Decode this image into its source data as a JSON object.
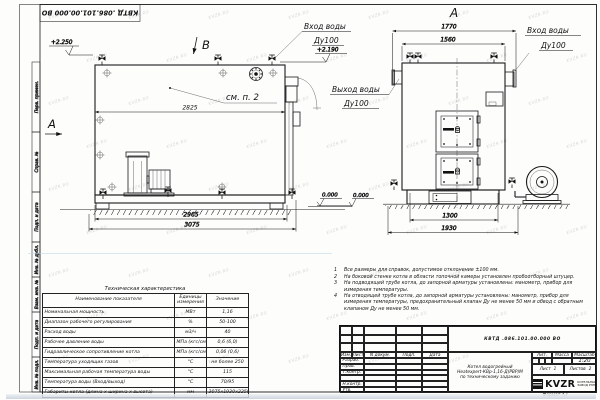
{
  "sheet": {
    "doc_number": "КВТД .086.101.00.000  ВО",
    "format_label": "Формат  А3",
    "title_line1": "Котел водогрейный",
    "title_line2": "Heatexpert-КВр-1,16-Д(РВР)М",
    "title_line3": "по техническому заданию",
    "scale_value": "1:20",
    "lit_label": "Лит.",
    "mass_label": "Масса",
    "scale_label": "Масштаб",
    "sheet_label": "Лист",
    "sheet_value": "1",
    "sheets_label": "Листов",
    "sheets_value": "2",
    "logo_text": "KVZR",
    "logo_sub1": "КОТЕЛЬНЫЙ",
    "logo_sub2": "ЗАВОД РЭП",
    "header_cols": [
      "Изм.",
      "Лист",
      "N докум.",
      "Подп.",
      "Дата"
    ],
    "sig_rows": [
      "Разраб.",
      "Пров.",
      "Т.контр.",
      "",
      "Н.контр.",
      "Утв."
    ]
  },
  "frame_stamps": [
    "Перв. примен.",
    "Справ. №",
    "Подп. и дата",
    "Инв. № дубл.",
    "Взам. инв. №",
    "Подп. и дата",
    "Инв. № подл."
  ],
  "side_view": {
    "b_label": "В",
    "a_label": "А",
    "see_note": "см. п. 2",
    "dim_top": "2825",
    "dim_mid": "2965",
    "dim_bottom": "3075",
    "level_top": "+2.250",
    "level_inlet": "+2.190",
    "level_zero": "0.000",
    "inlet_l1": "Вход воды",
    "inlet_l2": "Ду100"
  },
  "front_view": {
    "view_label": "А",
    "dim_t1": "1770",
    "dim_t2": "1560",
    "dim_b1": "1300",
    "dim_b2": "1930",
    "outlet_l1": "Выход воды",
    "outlet_l2": "Ду100",
    "inlet_l1": "Вход воды",
    "inlet_l2": "Ду100",
    "level_zero": "0.000"
  },
  "notes": [
    {
      "n": "1",
      "text": "Все размеры для справок, допустимое отклонение ±100 мм."
    },
    {
      "n": "2",
      "text": "На боковой стенке котла в области топочной камеры установлен пробоотборный штуцер."
    },
    {
      "n": "3",
      "text": "На подводящей трубе котла, до запорной арматуры установлены: манометр, прибор для измерения температуры."
    },
    {
      "n": "4",
      "text": "На отводящей трубе котла, до запорной арматуры установлены: манометр, прибор для измерения температуры, предохранительный клапан Ду не менее 50 мм и обвод с обратным клапаном Ду не менее 50 мм."
    }
  ],
  "table": {
    "title": "Техническая характеристика",
    "headers": [
      "Наименование показателя",
      "Единицы измерения",
      "Значение"
    ],
    "rows": [
      [
        "Номинальная мощность",
        "МВт",
        "1,16"
      ],
      [
        "Диапазон рабочего регулирования",
        "%",
        "50-100"
      ],
      [
        "Расход воды",
        "м3/ч",
        "40"
      ],
      [
        "Рабочее давление воды",
        "МПа (кгс/см2)",
        "0,6 (6,0)"
      ],
      [
        "Гидравлическое сопротивление котла",
        "МПа (кгс/см2)",
        "0,06 (0,6)"
      ],
      [
        "Температура уходящих газов",
        "°С",
        "не более 250"
      ],
      [
        "Максимальная рабочая температура воды",
        "°С",
        "115"
      ],
      [
        "Температура воды (Вход/выход)",
        "°С",
        "70/95"
      ],
      [
        "Габариты котла (длина х ширина х высота)",
        "мм",
        "3075х1930х2250"
      ]
    ]
  },
  "watermark": {
    "text": "KVZR.RU"
  }
}
